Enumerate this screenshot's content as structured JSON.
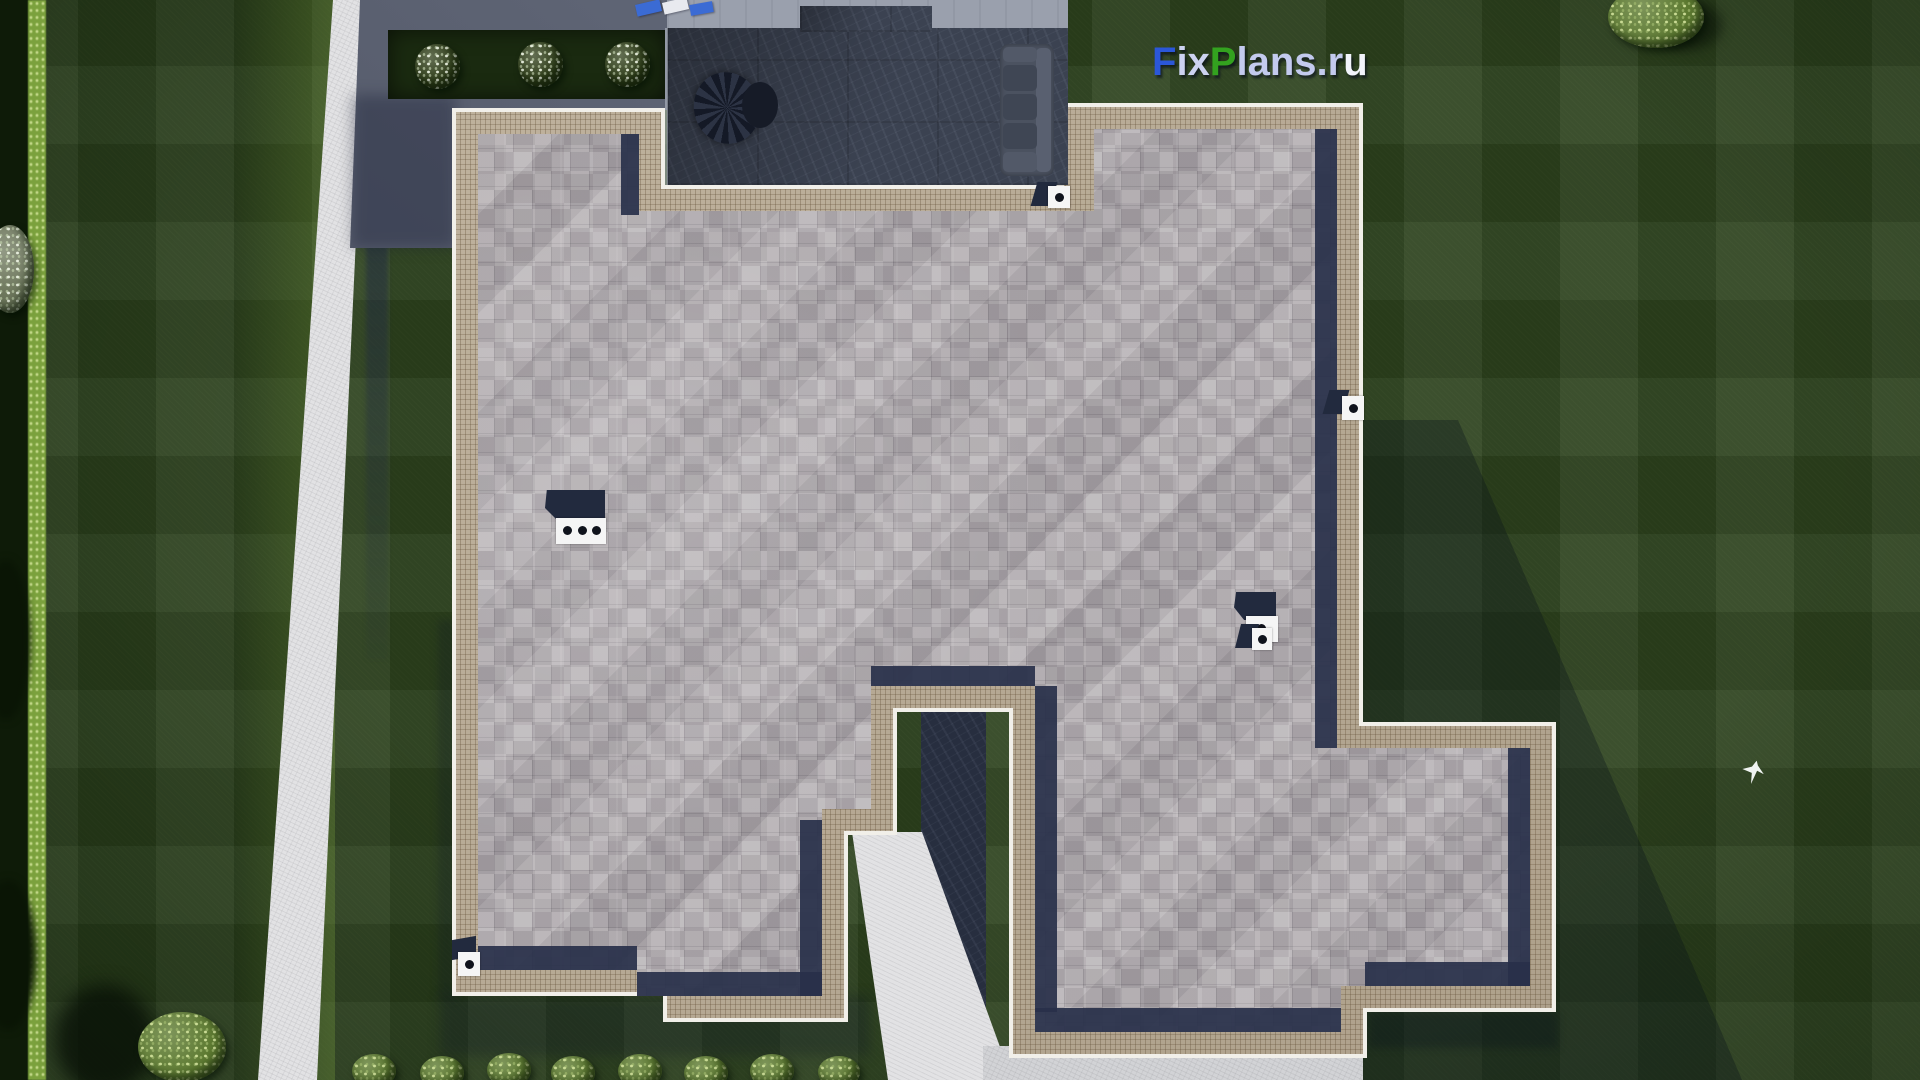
{
  "watermark": {
    "full_text": "FixPlans.ru",
    "parts": [
      {
        "text": "F",
        "color": "#2b57d8"
      },
      {
        "text": "ix",
        "color": "#ccd2f0"
      },
      {
        "text": "P",
        "color": "#33a21f"
      },
      {
        "text": "lans.r",
        "color": "#c3caee"
      },
      {
        "text": "u",
        "color": "#f2f4fb"
      }
    ]
  },
  "scene": {
    "description": "Aerial top-down 3D architectural render of a single-family house plot: gray shingled hip roof with beige eave borders, dark slate terrace with outdoor sofa and parasol table at top, recessed entry courtyard at bottom, white garden paths, concrete driveway apron, lawn with mowing stripes, flower bed, bush row and perimeter trees; white bird flying over lawn",
    "objects": [
      "hip roof with gray shingle tiles",
      "beige comb-textured eave borders",
      "dark slate terrace",
      "outdoor corner sofa",
      "patio parasol table set",
      "sun loungers",
      "two chimneys",
      "four roof vents",
      "entry courtyard in shadow",
      "white garden path",
      "entry walkway",
      "driveway apron",
      "flower bed with three white-flowering shrubs",
      "row of trimmed bushes",
      "striped lawn",
      "perimeter hedge and trees",
      "white bird in flight"
    ],
    "palette": {
      "lawn": "#2c411d",
      "lawn_dark": "#16250e",
      "hedge_light": "#7ba13d",
      "path": "#e2e2e4",
      "driveway": "#596072",
      "driveway_light": "#9aa0ad",
      "roof_shingles": "#b1acaf",
      "roof_eave": "#bcae97",
      "roof_fascia": "#f1efe9",
      "shadow_navy": "#28304a",
      "terrace": "#3b4251",
      "courtyard_shadow": "#272e3f",
      "furniture": "#4b5260",
      "chimney_white": "#f5f5f5",
      "flower_bed": "#1a2a10",
      "flower_white": "#e9ede1",
      "bush_green": "#5d7a31",
      "tree_green": "#4c6a2e",
      "bird_white": "#f0f4f2"
    }
  }
}
